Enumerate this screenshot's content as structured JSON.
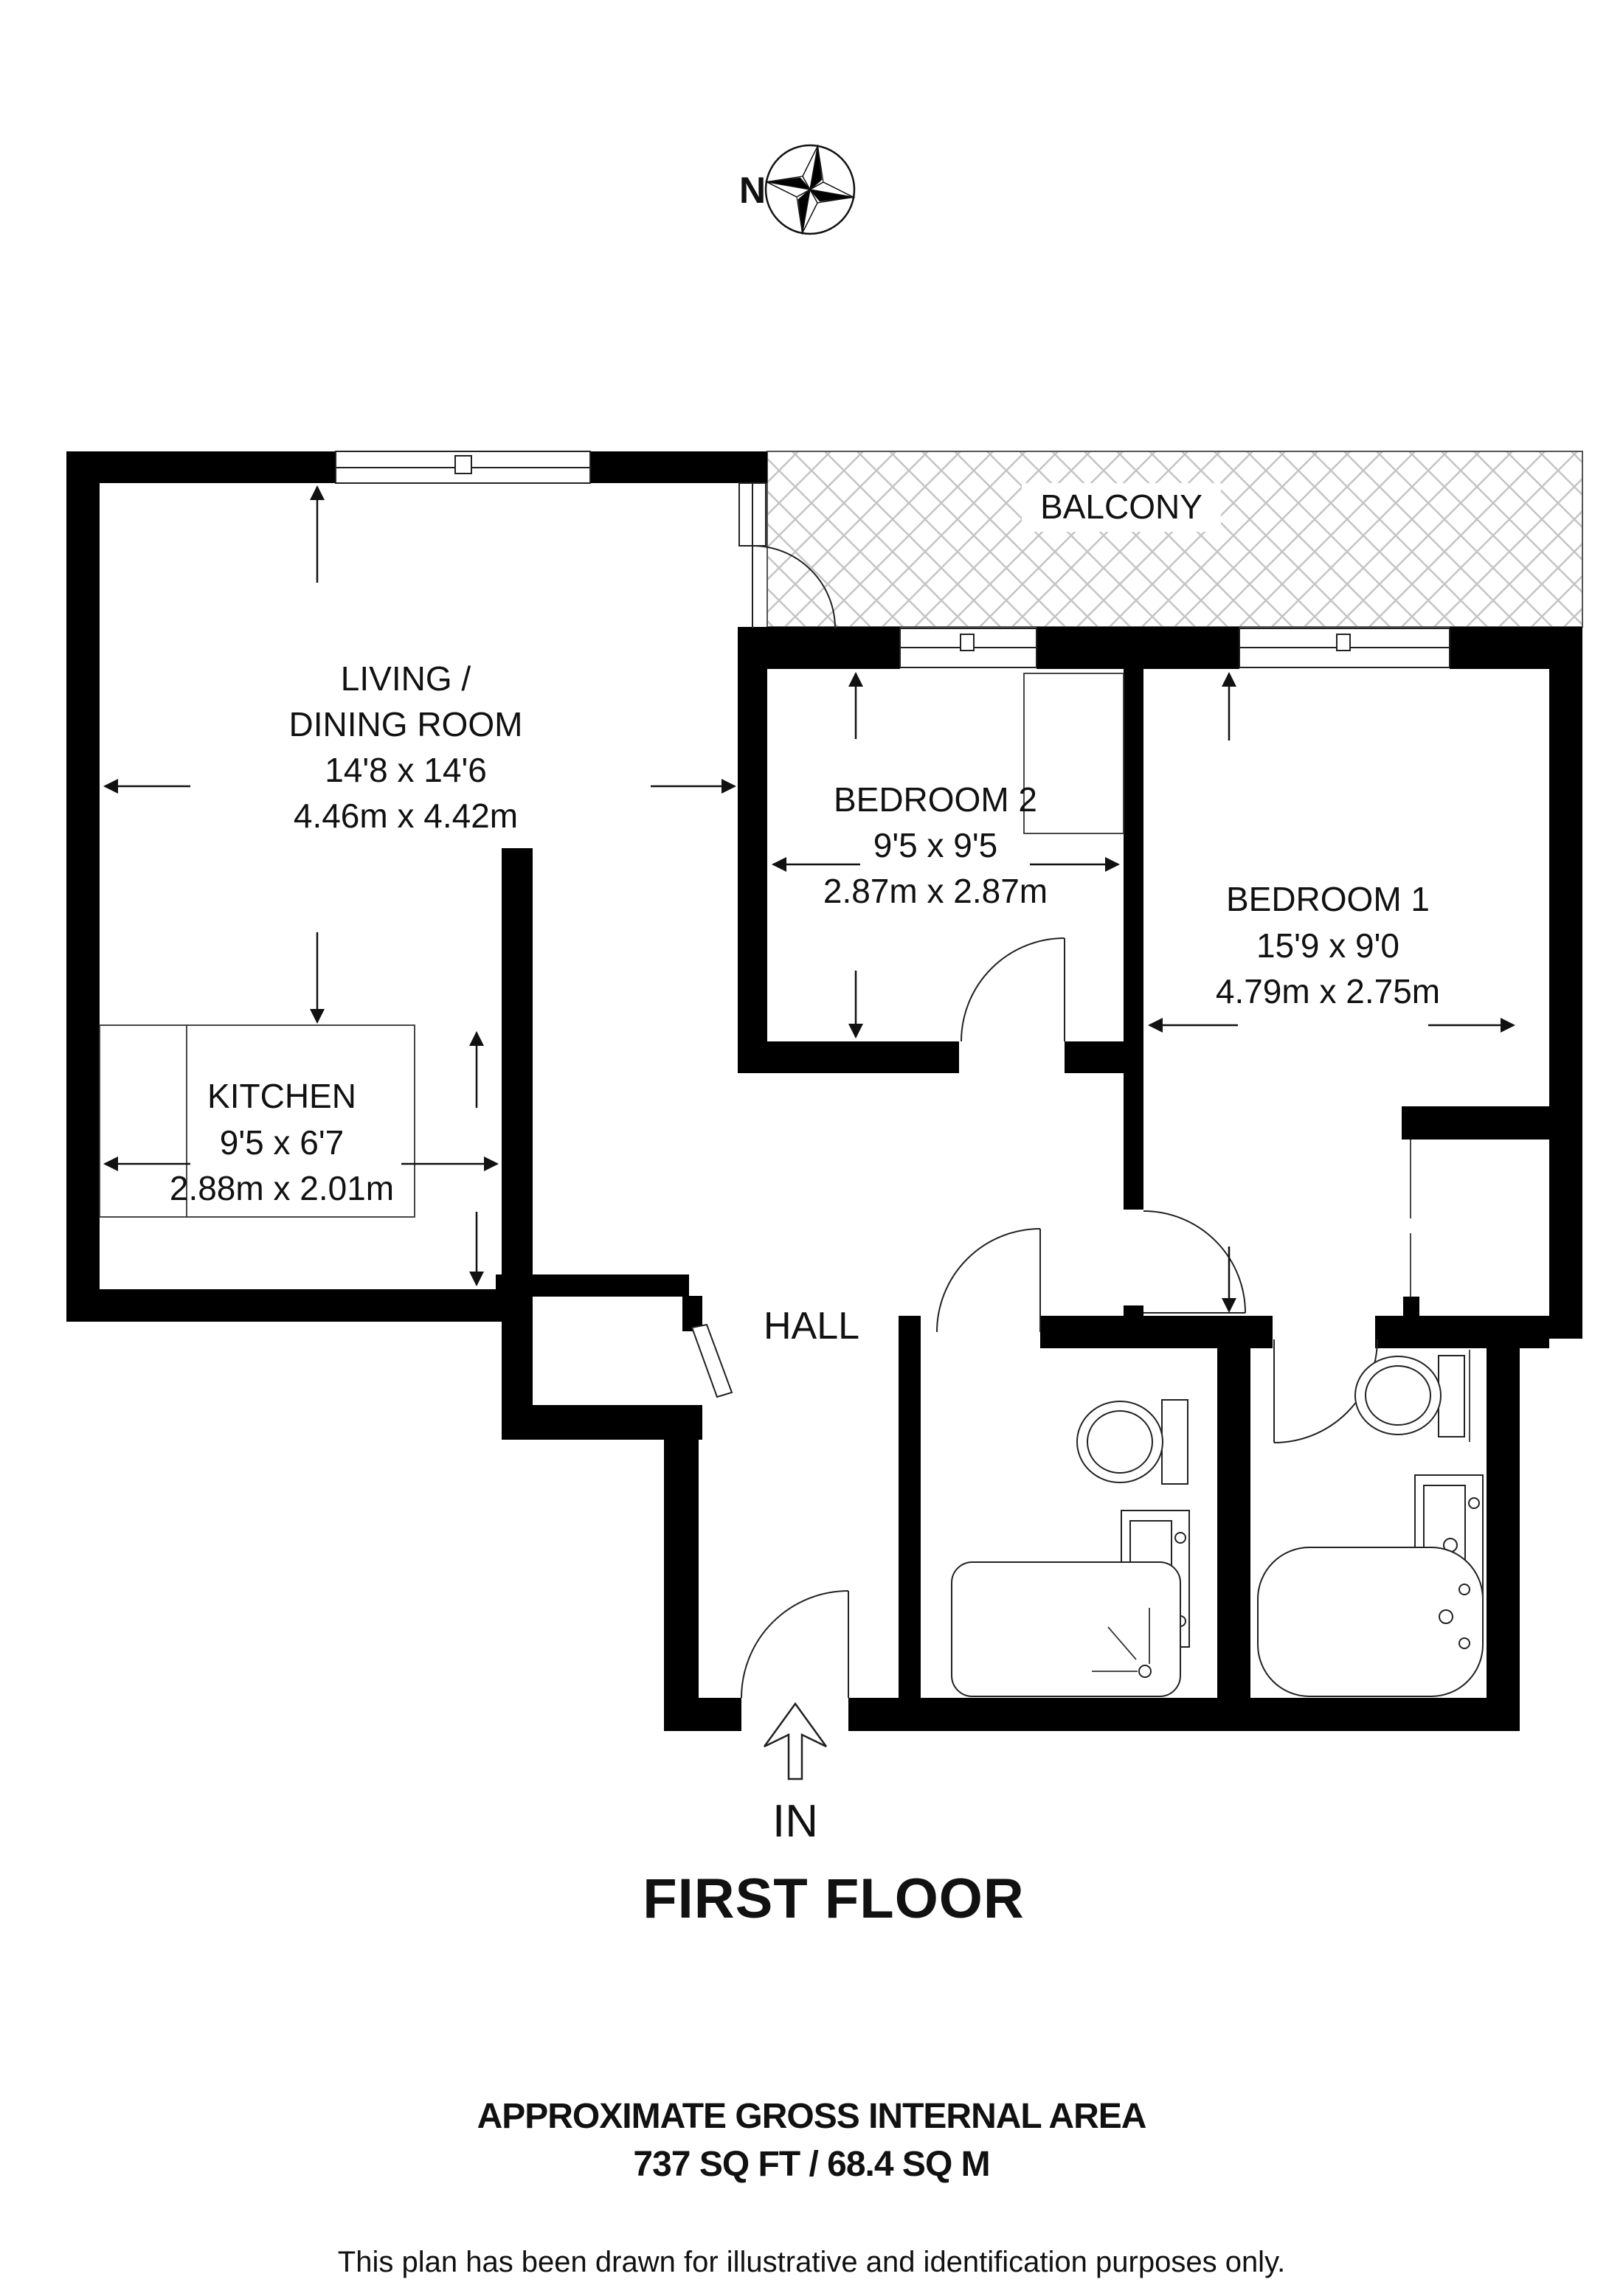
{
  "compass": {
    "north_label": "N"
  },
  "balcony": {
    "label": "BALCONY"
  },
  "rooms": {
    "living": {
      "name_line1": "LIVING /",
      "name_line2": "DINING ROOM",
      "imperial": "14'8 x 14'6",
      "metric": "4.46m x 4.42m"
    },
    "kitchen": {
      "name": "KITCHEN",
      "imperial": "9'5 x 6'7",
      "metric": "2.88m x 2.01m"
    },
    "bedroom2": {
      "name": "BEDROOM 2",
      "imperial": "9'5 x 9'5",
      "metric": "2.87m x 2.87m"
    },
    "bedroom1": {
      "name": "BEDROOM 1",
      "imperial": "15'9 x 9'0",
      "metric": "4.79m x 2.75m"
    },
    "hall": {
      "name": "HALL"
    }
  },
  "entrance": {
    "label": "IN"
  },
  "floor_title": "FIRST FLOOR",
  "footer": {
    "area_heading": "APPROXIMATE GROSS INTERNAL AREA",
    "area_value": "737 SQ FT / 68.4 SQ M",
    "disclaimer": "This plan has been drawn for illustrative and identification purposes only."
  },
  "colors": {
    "wall": "#000000",
    "hatch": "#c4c4c4",
    "background": "#ffffff"
  }
}
